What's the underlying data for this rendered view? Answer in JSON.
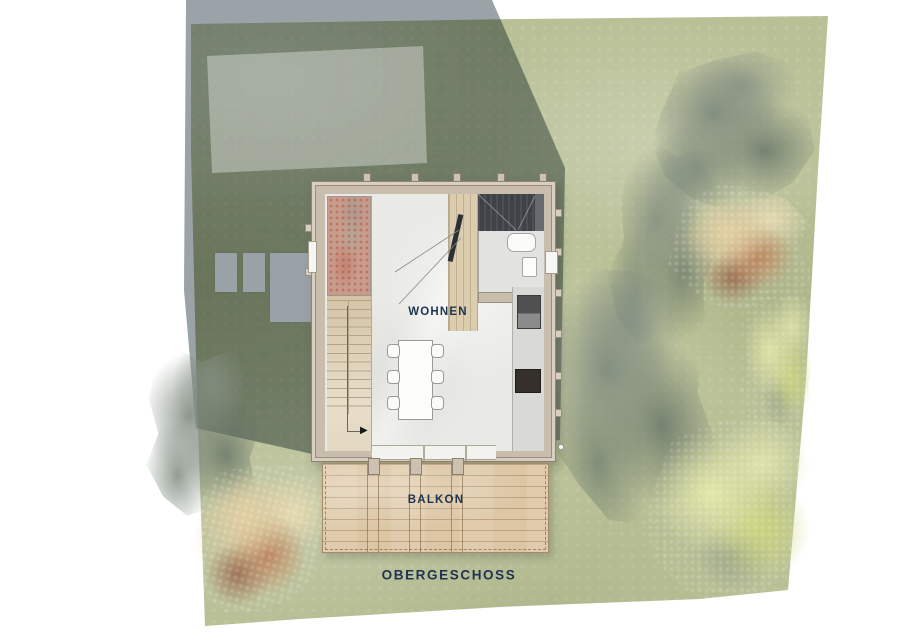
{
  "labels": {
    "living_room": "WOHNEN",
    "balcony": "BALKON",
    "floor_caption": "OBERGESCHOSS"
  },
  "icons": {
    "stair_direction_arrow": "▶"
  },
  "colors": {
    "label_text": "#21344f",
    "site_green": "#b9c096",
    "shadow_gray": "#9aa3a8",
    "wall_beige": "#c9bead",
    "wall_trim": "#d8cfc0",
    "living_floor": "#e9e9e6",
    "stair_wood": "#ddd0b6",
    "balcony_wood": "#dcc6a4",
    "dark_roof_space": "#3f4246",
    "void_red": "#c99c8d",
    "kitchen_counter": "#d9d9d6",
    "cooktop_dark": "#35302b",
    "tree_gray": "#7d877c",
    "tree_autumn": "#ba7e58",
    "tree_yellow": "#dce3a6"
  }
}
